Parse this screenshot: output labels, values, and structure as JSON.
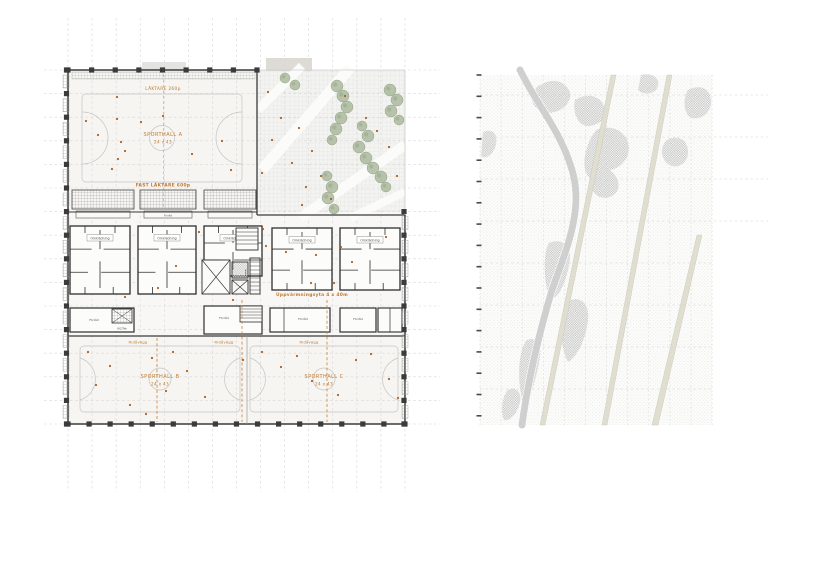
{
  "palette": {
    "accent": "#c17a33",
    "dot": "#ad6224",
    "tree": "#a9b79b",
    "tree_edge": "#93a383",
    "wall": "#3b3b3b",
    "court": "#c4c4c2",
    "grid": "#d6d6d6",
    "site_path": "#e0ded0"
  },
  "plan": {
    "stand_top": "LÄKTARE 260p",
    "hall_a": "SPORTHALL A",
    "hall_a_dims": "24 x 43",
    "stand_fixed": "FAST LÄKTARE 600p",
    "locker": "Omklädning",
    "warmup": "Uppvärmningsyta 4 x 40m",
    "storage": "Förråd",
    "wc": "WC/Tek",
    "curtain": "Ridåvägg",
    "hall_b": "SPORTHALL B",
    "hall_b_dims": "24 x 43",
    "hall_c": "SPORTHALL C",
    "hall_c_dims": "24 x 43"
  },
  "decor": {
    "dots": [
      [
        98,
        135
      ],
      [
        117,
        119
      ],
      [
        121,
        142
      ],
      [
        125,
        151
      ],
      [
        118,
        159
      ],
      [
        112,
        169
      ],
      [
        141,
        122
      ],
      [
        163,
        116
      ],
      [
        192,
        154
      ],
      [
        222,
        141
      ],
      [
        117,
        97
      ],
      [
        231,
        170
      ],
      [
        86,
        121
      ],
      [
        268,
        92
      ],
      [
        281,
        118
      ],
      [
        299,
        128
      ],
      [
        312,
        151
      ],
      [
        292,
        163
      ],
      [
        306,
        187
      ],
      [
        321,
        176
      ],
      [
        345,
        96
      ],
      [
        366,
        118
      ],
      [
        377,
        131
      ],
      [
        389,
        147
      ],
      [
        397,
        176
      ],
      [
        331,
        199
      ],
      [
        302,
        205
      ],
      [
        272,
        140
      ],
      [
        262,
        173
      ],
      [
        199,
        232
      ],
      [
        263,
        229
      ],
      [
        266,
        246
      ],
      [
        286,
        252
      ],
      [
        316,
        255
      ],
      [
        341,
        247
      ],
      [
        352,
        262
      ],
      [
        386,
        237
      ],
      [
        176,
        266
      ],
      [
        158,
        288
      ],
      [
        125,
        297
      ],
      [
        233,
        300
      ],
      [
        311,
        283
      ],
      [
        334,
        283
      ],
      [
        88,
        352
      ],
      [
        110,
        366
      ],
      [
        96,
        385
      ],
      [
        130,
        405
      ],
      [
        152,
        358
      ],
      [
        173,
        352
      ],
      [
        187,
        371
      ],
      [
        205,
        397
      ],
      [
        166,
        391
      ],
      [
        243,
        360
      ],
      [
        262,
        352
      ],
      [
        281,
        367
      ],
      [
        297,
        356
      ],
      [
        312,
        381
      ],
      [
        338,
        395
      ],
      [
        356,
        360
      ],
      [
        371,
        354
      ],
      [
        389,
        379
      ],
      [
        398,
        398
      ],
      [
        146,
        414
      ]
    ],
    "trees": [
      [
        337,
        86,
        6
      ],
      [
        343,
        96,
        6
      ],
      [
        347,
        107,
        6
      ],
      [
        341,
        118,
        6
      ],
      [
        336,
        129,
        6
      ],
      [
        332,
        140,
        5
      ],
      [
        390,
        90,
        6
      ],
      [
        397,
        100,
        6
      ],
      [
        391,
        111,
        6
      ],
      [
        399,
        120,
        5
      ],
      [
        362,
        126,
        5
      ],
      [
        368,
        136,
        6
      ],
      [
        359,
        147,
        6
      ],
      [
        366,
        158,
        6
      ],
      [
        373,
        168,
        6
      ],
      [
        381,
        177,
        6
      ],
      [
        386,
        187,
        5
      ],
      [
        327,
        176,
        5
      ],
      [
        332,
        187,
        6
      ],
      [
        328,
        198,
        6
      ],
      [
        334,
        209,
        5
      ],
      [
        285,
        78,
        5
      ],
      [
        295,
        85,
        5
      ]
    ]
  }
}
